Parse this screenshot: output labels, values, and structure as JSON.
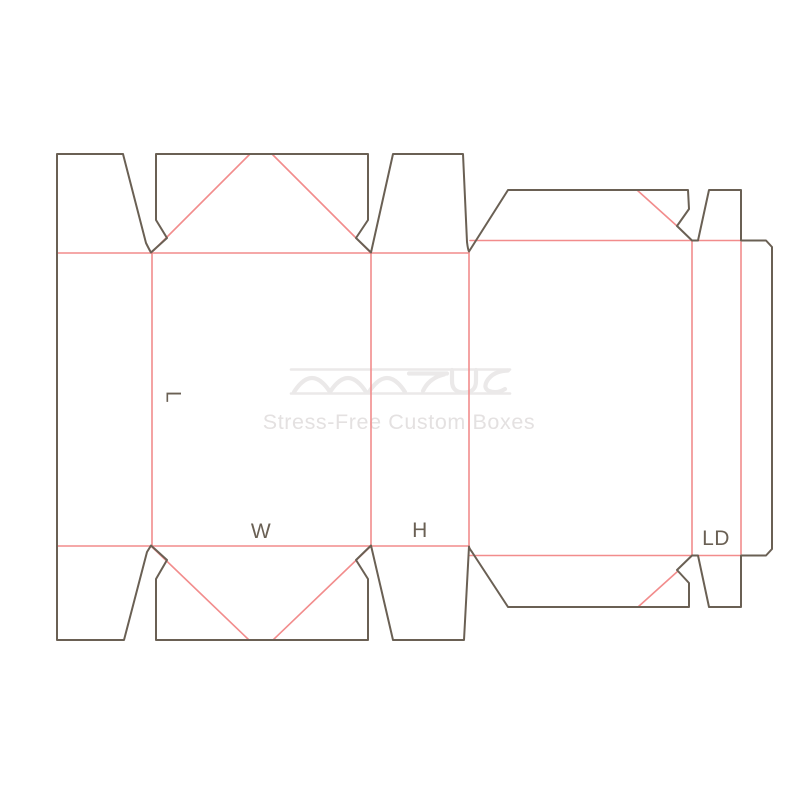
{
  "page": {
    "background": "#ffffff",
    "description": "Dieline template drawing of a custom box on white background"
  },
  "diagram": {
    "type": "packaging-dieline",
    "labels": {
      "length": "L",
      "width": "W",
      "height": "H",
      "lid_depth": "LD"
    },
    "colors": {
      "cut_line": "#6a6054",
      "crease_line": "#f28c8c",
      "label_text": "#6a6054",
      "watermark": "#ebe9e9",
      "watermark_text": "#e4e1e1"
    }
  },
  "watermark": {
    "logo_icon": "matus-wave-logo",
    "tagline": "Stress-Free Custom Boxes"
  }
}
